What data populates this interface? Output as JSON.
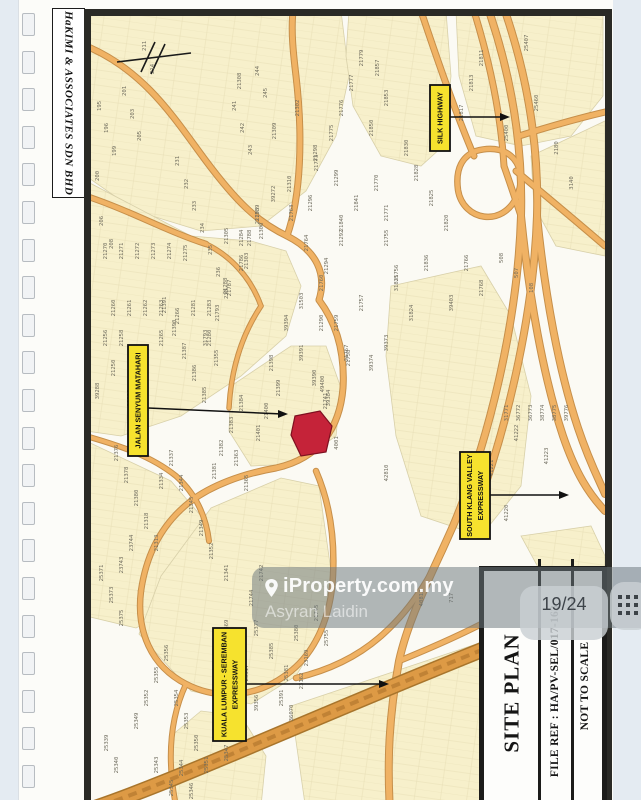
{
  "stamp": {
    "text": "HaKIMI & ASSOCIATES SDN BHD"
  },
  "binder": {
    "holes": 21
  },
  "overlay": {
    "brand": "iProperty.com.my",
    "agent": "Asyran Laidin",
    "pager": "19/24",
    "pin_icon": "location-pin",
    "grid_icon": "grid-dots"
  },
  "title_block": {
    "title": "SITE PLAN",
    "file_ref": "FILE REF : HA/PV-SEL/017-163",
    "scale_note": "NOT TO SCALE"
  },
  "map": {
    "colors": {
      "bg": "#fbfaf4",
      "parcel": "#f7f0cb",
      "parcel_line": "#d8d0a9",
      "road": "#f0b264",
      "road_casing": "#c68f4a",
      "expressway": "#dd9a45",
      "expressway_casing": "#a8752c",
      "highlight": "#c52339",
      "highlight_line": "#7e1020",
      "label_bg": "#f6e22e",
      "label_border": "#111111",
      "arrow": "#111111",
      "lot_text": "#6d6a5c"
    },
    "labels": [
      {
        "lines": [
          "SILK HIGHWAY"
        ],
        "x": 339,
        "y": 69,
        "w": 20,
        "h": 66,
        "arrow": [
          359,
          101,
          419,
          101
        ]
      },
      {
        "lines": [
          "JALAN SENYUM MATAHARI"
        ],
        "x": 37,
        "y": 329,
        "w": 20,
        "h": 111,
        "arrow": [
          57,
          392,
          197,
          398
        ]
      },
      {
        "lines": [
          "SOUTH KLANG VALLEY",
          "EXPRESSWAY"
        ],
        "x": 369,
        "y": 436,
        "w": 30,
        "h": 87,
        "arrow": [
          399,
          479,
          478,
          479
        ]
      },
      {
        "lines": [
          "KUALA LUMPUR - SEREMBAN",
          "EXPRESSWAY"
        ],
        "x": 122,
        "y": 612,
        "w": 33,
        "h": 113,
        "arrow": [
          155,
          668,
          298,
          668
        ]
      }
    ],
    "highlight_parcel": "204,400 229,395 241,410 235,436 210,440 200,419",
    "north_arrow": "M 26,46 L 100,37 M 64,26 L 50,56 M 74,28 L 60,58",
    "parcels": [
      "0,-5 250,-5 258,60 245,120 215,175 170,210 110,215 45,195 -5,160",
      "258,-5 355,-5 360,60 352,130 330,150 290,140 262,90 255,40",
      "365,-5 512,-5 512,80 480,120 430,130 385,120 368,60",
      "440,140 514,105 514,240 465,230 443,190",
      "-5,165 100,220 160,225 195,235 210,270 195,320 150,360 90,400 30,420 -5,415",
      "140,370 200,330 235,330 250,372 245,420 205,448 160,450 138,415",
      "-5,425 80,465 110,500 112,545 90,590 45,612 -5,600",
      "48,618 100,675 160,688 205,660 235,610 240,555 228,470 190,462 120,492 70,560",
      "85,790 80,720 110,695 150,700 175,740 170,790",
      "300,270 390,250 420,300 440,380 430,470 390,520 330,500 305,420 295,340",
      "200,690 514,585 514,795 215,795",
      "430,520 500,510 514,540 514,560 460,575"
    ],
    "roads": [
      {
        "d": "M -5,30 C 55,55 85,105 115,145 C 145,185 165,205 196,220 C 226,235 236,258 228,284",
        "w": 5
      },
      {
        "d": "M 196,220 C 210,180 212,120 205,60 C 202,35 200,15 202,-5",
        "w": 5
      },
      {
        "d": "M 228,284 C 246,308 254,338 252,372 C 249,410 230,442 185,452 C 150,458 120,470 100,485",
        "w": 5
      },
      {
        "d": "M 100,485 C 70,508 55,540 50,575",
        "w": 4.5
      },
      {
        "d": "M -5,180 C 40,195 75,215 115,228",
        "w": 4.5
      },
      {
        "d": "M -5,420 C 30,430 60,440 85,460 C 105,478 115,500 118,525",
        "w": 4
      },
      {
        "d": "M 50,575 C 45,615 60,650 95,668 C 130,686 170,680 200,655",
        "w": 4.5
      },
      {
        "d": "M 95,668 C 80,700 75,740 85,790",
        "w": 4
      },
      {
        "d": "M 200,655 C 225,635 240,600 242,560 C 244,520 238,485 225,455",
        "w": 4.5
      },
      {
        "d": "M 115,228 C 140,240 160,262 170,290",
        "w": 3.5
      },
      {
        "d": "M 170,290 C 150,320 140,355 138,392",
        "w": 3.5
      },
      {
        "d": "M 398,-5 C 420,60 432,130 430,200 C 427,300 400,420 362,510 C 340,560 318,600 308,645 C 298,700 296,745 299,795",
        "w": 6
      },
      {
        "d": "M 414,-5 C 436,60 448,130 446,200 C 443,290 420,400 385,495",
        "w": 6
      },
      {
        "d": "M 383,-5 C 400,50 410,100 413,150",
        "w": 5
      },
      {
        "d": "M 330,-5 C 350,55 368,105 383,140",
        "w": 5
      },
      {
        "d": "M 413,150 C 420,170 425,185 430,200",
        "w": 5
      },
      {
        "d": "M 430,200 C 438,280 452,360 472,420 C 485,458 498,478 514,495",
        "w": 6
      },
      {
        "d": "M 446,200 C 454,280 468,355 487,412 C 499,448 510,468 514,478",
        "w": 6
      },
      {
        "d": "M 425,155 C 455,180 485,205 514,230",
        "w": 5
      },
      {
        "d": "M 428,120 C 460,110 488,102 514,96",
        "w": 5
      },
      {
        "d": "M 385,135 C 420,125 438,152 426,180 C 412,212 372,205 367,174 C 364,152 372,140 385,135",
        "w": 4.5
      },
      {
        "d": "M 362,510 C 345,555 322,592 290,620 C 265,642 235,655 205,662",
        "w": 4.5
      },
      {
        "d": "M 308,645 C 340,632 372,618 402,602",
        "w": 4.5
      }
    ],
    "expressways": [
      {
        "d": "M -5,795 C 100,760 220,700 514,585",
        "w": 13
      }
    ],
    "lots": [
      [
        "195",
        10,
        90
      ],
      [
        "196",
        17,
        112
      ],
      [
        "199",
        25,
        135
      ],
      [
        "200",
        8,
        160
      ],
      [
        "201",
        35,
        75
      ],
      [
        "203",
        43,
        98
      ],
      [
        "205",
        50,
        120
      ],
      [
        "206",
        12,
        205
      ],
      [
        "208",
        22,
        228
      ],
      [
        "211",
        55,
        30
      ],
      [
        "214",
        63,
        53
      ],
      [
        "231",
        88,
        145
      ],
      [
        "232",
        97,
        168
      ],
      [
        "233",
        105,
        190
      ],
      [
        "234",
        113,
        212
      ],
      [
        "235",
        121,
        234
      ],
      [
        "236",
        129,
        256
      ],
      [
        "238",
        137,
        278
      ],
      [
        "241",
        145,
        90
      ],
      [
        "242",
        153,
        112
      ],
      [
        "243",
        161,
        134
      ],
      [
        "244",
        168,
        55
      ],
      [
        "245",
        176,
        77
      ],
      [
        "21308",
        150,
        65
      ],
      [
        "21309",
        185,
        115
      ],
      [
        "21310",
        200,
        168
      ],
      [
        "21302",
        208,
        92
      ],
      [
        "21300",
        172,
        215
      ],
      [
        "21305",
        137,
        220
      ],
      [
        "21303",
        157,
        245
      ],
      [
        "21298",
        226,
        137
      ],
      [
        "21299",
        247,
        162
      ],
      [
        "21296",
        221,
        187
      ],
      [
        "21294",
        237,
        250
      ],
      [
        "21292",
        252,
        222
      ],
      [
        "31503",
        212,
        285
      ],
      [
        "21290",
        232,
        307
      ],
      [
        "21857",
        288,
        52
      ],
      [
        "21853",
        297,
        82
      ],
      [
        "21850",
        282,
        112
      ],
      [
        "21830",
        317,
        132
      ],
      [
        "21828",
        327,
        157
      ],
      [
        "21825",
        342,
        182
      ],
      [
        "21820",
        357,
        207
      ],
      [
        "21817",
        372,
        97
      ],
      [
        "21813",
        382,
        67
      ],
      [
        "21811",
        392,
        42
      ],
      [
        "21841",
        267,
        187
      ],
      [
        "21840",
        252,
        207
      ],
      [
        "21836",
        337,
        247
      ],
      [
        "31835",
        307,
        267
      ],
      [
        "31824",
        322,
        297
      ],
      [
        "39403",
        362,
        287
      ],
      [
        "39373",
        297,
        327
      ],
      [
        "39374",
        282,
        347
      ],
      [
        "21766",
        377,
        247
      ],
      [
        "21768",
        392,
        272
      ],
      [
        "21767",
        257,
        337
      ],
      [
        "25407",
        437,
        27
      ],
      [
        "25400",
        417,
        117
      ],
      [
        "25460",
        447,
        87
      ],
      [
        "2180",
        467,
        132
      ],
      [
        "3140",
        482,
        167
      ],
      [
        "508",
        412,
        242
      ],
      [
        "507",
        427,
        257
      ],
      [
        "108",
        442,
        272
      ],
      [
        "21779",
        272,
        42
      ],
      [
        "21777",
        262,
        67
      ],
      [
        "21776",
        252,
        92
      ],
      [
        "21775",
        242,
        117
      ],
      [
        "21773",
        227,
        147
      ],
      [
        "21770",
        287,
        167
      ],
      [
        "21771",
        297,
        197
      ],
      [
        "21764",
        217,
        227
      ],
      [
        "21763",
        202,
        197
      ],
      [
        "21760",
        232,
        267
      ],
      [
        "21759",
        247,
        307
      ],
      [
        "21758",
        259,
        342
      ],
      [
        "21757",
        272,
        287
      ],
      [
        "21755",
        297,
        222
      ],
      [
        "21756",
        307,
        257
      ],
      [
        "21270",
        16,
        235
      ],
      [
        "21271",
        32,
        235
      ],
      [
        "21272",
        48,
        235
      ],
      [
        "21273",
        64,
        235
      ],
      [
        "21274",
        80,
        235
      ],
      [
        "21275",
        96,
        237
      ],
      [
        "21260",
        24,
        292
      ],
      [
        "21261",
        40,
        292
      ],
      [
        "21262",
        56,
        292
      ],
      [
        "21263",
        72,
        292
      ],
      [
        "21256",
        16,
        322
      ],
      [
        "21258",
        32,
        322
      ],
      [
        "21250",
        24,
        352
      ],
      [
        "21255",
        48,
        352
      ],
      [
        "21265",
        72,
        322
      ],
      [
        "21266",
        88,
        300
      ],
      [
        "21281",
        104,
        292
      ],
      [
        "21283",
        120,
        292
      ],
      [
        "21280",
        120,
        322
      ],
      [
        "21288",
        136,
        270
      ],
      [
        "21284",
        152,
        222
      ],
      [
        "21293",
        168,
        200
      ],
      [
        "39272",
        184,
        178
      ],
      [
        "39288",
        8,
        375
      ],
      [
        "39286",
        40,
        382
      ],
      [
        "21786",
        152,
        247
      ],
      [
        "21787",
        140,
        272
      ],
      [
        "21793",
        128,
        297
      ],
      [
        "31793",
        116,
        322
      ],
      [
        "21788",
        160,
        222
      ],
      [
        "21789",
        168,
        197
      ],
      [
        "39394",
        197,
        307
      ],
      [
        "39391",
        212,
        337
      ],
      [
        "39390",
        225,
        362
      ],
      [
        "39384",
        239,
        382
      ],
      [
        "21398",
        182,
        347
      ],
      [
        "21399",
        189,
        372
      ],
      [
        "21400",
        177,
        395
      ],
      [
        "21401",
        169,
        417
      ],
      [
        "21384",
        152,
        387
      ],
      [
        "21383",
        142,
        409
      ],
      [
        "21382",
        132,
        432
      ],
      [
        "21381",
        125,
        455
      ],
      [
        "21385",
        115,
        379
      ],
      [
        "21386",
        105,
        357
      ],
      [
        "21387",
        95,
        335
      ],
      [
        "21390",
        85,
        312
      ],
      [
        "21391",
        75,
        289
      ],
      [
        "21365",
        157,
        467
      ],
      [
        "21363",
        147,
        442
      ],
      [
        "21355",
        127,
        342
      ],
      [
        "21344",
        92,
        467
      ],
      [
        "21345",
        102,
        489
      ],
      [
        "21349",
        112,
        512
      ],
      [
        "21352",
        122,
        535
      ],
      [
        "21337",
        82,
        442
      ],
      [
        "21334",
        72,
        465
      ],
      [
        "21376",
        27,
        437
      ],
      [
        "21378",
        37,
        459
      ],
      [
        "21380",
        47,
        482
      ],
      [
        "21318",
        57,
        505
      ],
      [
        "21313",
        67,
        527
      ],
      [
        "21341",
        137,
        557
      ],
      [
        "21741",
        236,
        385
      ],
      [
        "49400",
        233,
        368
      ],
      [
        "21744",
        162,
        582
      ],
      [
        "21742",
        172,
        557
      ],
      [
        "25371",
        12,
        557
      ],
      [
        "25373",
        22,
        579
      ],
      [
        "25375",
        32,
        602
      ],
      [
        "25356",
        77,
        637
      ],
      [
        "25355",
        67,
        659
      ],
      [
        "25354",
        87,
        682
      ],
      [
        "25352",
        57,
        682
      ],
      [
        "25353",
        97,
        705
      ],
      [
        "25350",
        107,
        727
      ],
      [
        "25351",
        117,
        749
      ],
      [
        "25349",
        47,
        705
      ],
      [
        "25344",
        92,
        752
      ],
      [
        "25346",
        102,
        775
      ],
      [
        "25343",
        67,
        749
      ],
      [
        "25345",
        82,
        772
      ],
      [
        "25340",
        27,
        749
      ],
      [
        "25339",
        17,
        727
      ],
      [
        "25347",
        137,
        737
      ],
      [
        "25348",
        127,
        715
      ],
      [
        "25317",
        157,
        657
      ],
      [
        "25368",
        147,
        635
      ],
      [
        "25369",
        137,
        612
      ],
      [
        "39356",
        167,
        687
      ],
      [
        "23744",
        42,
        527
      ],
      [
        "23743",
        32,
        549
      ],
      [
        "25377",
        167,
        612
      ],
      [
        "25385",
        182,
        635
      ],
      [
        "25381",
        197,
        657
      ],
      [
        "25391",
        192,
        682
      ],
      [
        "25380",
        207,
        617
      ],
      [
        "23169",
        217,
        642
      ],
      [
        "21745",
        227,
        597
      ],
      [
        "25755",
        237,
        622
      ],
      [
        "23162",
        212,
        665
      ],
      [
        "36070",
        202,
        697
      ],
      [
        "41220",
        417,
        497
      ],
      [
        "41221",
        402,
        452
      ],
      [
        "41222",
        427,
        417
      ],
      [
        "1305",
        387,
        477
      ],
      [
        "717",
        362,
        582
      ],
      [
        "40813",
        332,
        582
      ],
      [
        "42810",
        297,
        457
      ],
      [
        "41223",
        457,
        440
      ],
      [
        "4001",
        247,
        427
      ],
      [
        "31771",
        417,
        397
      ],
      [
        "36772",
        429,
        397
      ],
      [
        "36773",
        441,
        397
      ],
      [
        "38774",
        453,
        397
      ],
      [
        "38775",
        465,
        397
      ],
      [
        "39776",
        477,
        397
      ]
    ]
  }
}
